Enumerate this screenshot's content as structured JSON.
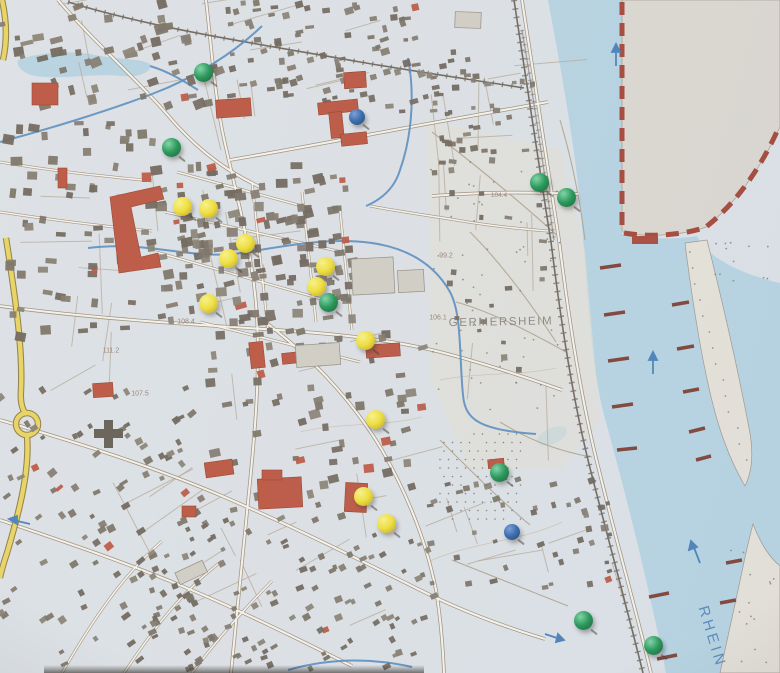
{
  "scene": {
    "description": "Paper topographic city map of Germersheim am Rhein with colored pushpins marking locations",
    "map_background": "#dce1e6",
    "water_color": "#b3d2e2",
    "land_color": "#e6e1d6",
    "foreign_area_color": "#dbd7cf",
    "boundary_color": "#a63b2b"
  },
  "labels": [
    {
      "id": "city-name",
      "text": "GERMERSHEIM",
      "x": 501,
      "y": 323,
      "size": 11.5,
      "color": "#7d786c",
      "spacing": 1.6,
      "rotate": -1,
      "opacity": 0.9
    },
    {
      "id": "river-name",
      "text": "RHEIN",
      "x": 712,
      "y": 637,
      "size": 15,
      "color": "#4a7fb5",
      "spacing": 3.5,
      "rotate": 73,
      "opacity": 0.95
    },
    {
      "id": "elevation",
      "text": "107.5",
      "x": 140,
      "y": 394,
      "size": 7,
      "color": "#8c7263",
      "spacing": 0,
      "rotate": 0,
      "opacity": 0.9
    },
    {
      "id": "elevation",
      "text": "111.2",
      "x": 111,
      "y": 351,
      "size": 7,
      "color": "#8c7263",
      "spacing": 0,
      "rotate": 0,
      "opacity": 0.9
    },
    {
      "id": "elevation",
      "text": "108.4",
      "x": 186,
      "y": 322,
      "size": 7,
      "color": "#8c7263",
      "spacing": 0,
      "rotate": 0,
      "opacity": 0.9
    },
    {
      "id": "elevation",
      "text": "99.2",
      "x": 446,
      "y": 256,
      "size": 7,
      "color": "#8c7263",
      "spacing": 0,
      "rotate": 0,
      "opacity": 0.9
    },
    {
      "id": "elevation",
      "text": "106.1",
      "x": 438,
      "y": 318,
      "size": 7,
      "color": "#8c7263",
      "spacing": 0,
      "rotate": 0,
      "opacity": 0.9
    },
    {
      "id": "elevation",
      "text": "104.4",
      "x": 499,
      "y": 196,
      "size": 6.5,
      "color": "#8c7263",
      "spacing": 0,
      "rotate": 0,
      "opacity": 0.9
    }
  ],
  "pins": [
    {
      "x": 203,
      "y": 72,
      "color": "green"
    },
    {
      "x": 357,
      "y": 117,
      "color": "blue"
    },
    {
      "x": 171,
      "y": 147,
      "color": "green"
    },
    {
      "x": 539,
      "y": 182,
      "color": "green"
    },
    {
      "x": 566,
      "y": 197,
      "color": "green"
    },
    {
      "x": 182,
      "y": 206,
      "color": "yellow"
    },
    {
      "x": 208,
      "y": 208,
      "color": "yellow"
    },
    {
      "x": 245,
      "y": 243,
      "color": "yellow"
    },
    {
      "x": 228,
      "y": 258,
      "color": "yellow"
    },
    {
      "x": 325,
      "y": 266,
      "color": "yellow"
    },
    {
      "x": 316,
      "y": 286,
      "color": "yellow"
    },
    {
      "x": 328,
      "y": 302,
      "color": "green"
    },
    {
      "x": 208,
      "y": 303,
      "color": "yellow"
    },
    {
      "x": 365,
      "y": 340,
      "color": "yellow"
    },
    {
      "x": 375,
      "y": 419,
      "color": "yellow"
    },
    {
      "x": 499,
      "y": 472,
      "color": "green"
    },
    {
      "x": 363,
      "y": 496,
      "color": "yellow"
    },
    {
      "x": 386,
      "y": 523,
      "color": "yellow"
    },
    {
      "x": 512,
      "y": 532,
      "color": "blue"
    },
    {
      "x": 583,
      "y": 620,
      "color": "green"
    },
    {
      "x": 653,
      "y": 645,
      "color": "green"
    }
  ],
  "pin_styles": {
    "green": {
      "hi": "#79d4a2",
      "base": "#17914c",
      "lo": "#085229",
      "d": 19
    },
    "yellow": {
      "hi": "#fbf284",
      "base": "#f0df2f",
      "lo": "#b99b12",
      "d": 19
    },
    "blue": {
      "hi": "#6f9ad8",
      "base": "#2b5fa6",
      "lo": "#14375f",
      "d": 16
    }
  }
}
